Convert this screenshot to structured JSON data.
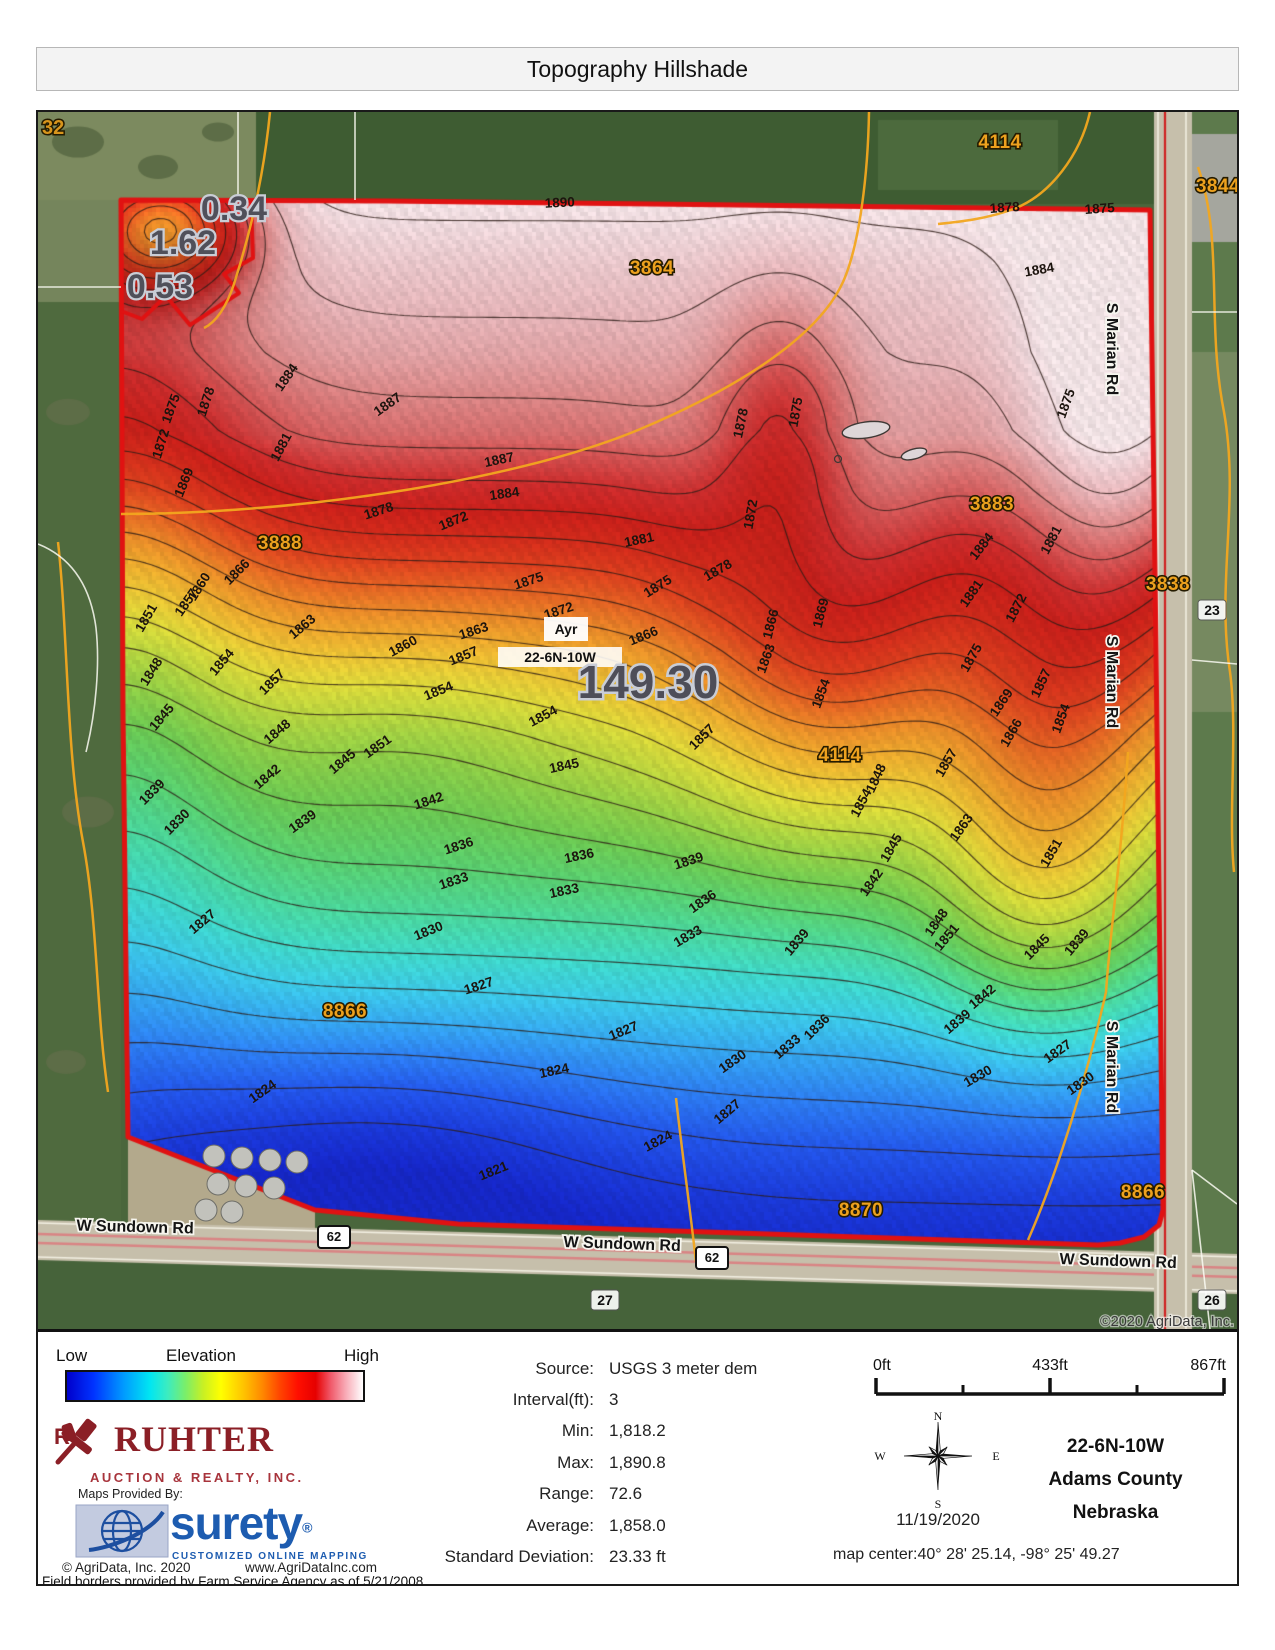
{
  "title": "Topography Hillshade",
  "legend": {
    "low": "Low",
    "label": "Elevation",
    "high": "High"
  },
  "branding": {
    "company": "RUHTER",
    "company_sub": "AUCTION & REALTY, INC.",
    "maps_provided_by": "Maps Provided By:",
    "surety": "surety",
    "surety_reg": "®",
    "surety_sub": "CUSTOMIZED ONLINE MAPPING",
    "copyright": "© AgriData, Inc. 2020",
    "website": "www.AgriDataInc.com",
    "field_borders_note": "Field borders provided by Farm Service Agency as of 5/21/2008."
  },
  "stats": {
    "rows": [
      {
        "label": "Source:",
        "value": "USGS 3 meter dem"
      },
      {
        "label": "Interval(ft):",
        "value": "3"
      },
      {
        "label": "Min:",
        "value": "1,818.2"
      },
      {
        "label": "Max:",
        "value": "1,890.8"
      },
      {
        "label": "Range:",
        "value": "72.6"
      },
      {
        "label": "Average:",
        "value": "1,858.0"
      },
      {
        "label": "Standard Deviation:",
        "value": "23.33 ft"
      }
    ]
  },
  "scalebar": {
    "ticks": [
      "0ft",
      "433ft",
      "867ft"
    ]
  },
  "location": {
    "date": "11/19/2020",
    "trs": "22-6N-10W",
    "county": "Adams County",
    "state": "Nebraska",
    "map_center": "map center:40° 28' 25.14,  -98° 25' 49.27",
    "compass": {
      "n": "N",
      "e": "E",
      "s": "S",
      "w": "W"
    }
  },
  "map": {
    "copyright": "©2020 AgriData, Inc.",
    "town_label": "Ayr",
    "trs_label": "22-6N-10W",
    "elevation": {
      "min": 1818.2,
      "max": 1890.8,
      "interval": 3
    },
    "acreage_labels": [
      {
        "t": "149.30",
        "x": 610,
        "y": 586,
        "big": true
      },
      {
        "t": "0.34",
        "x": 196,
        "y": 108,
        "big": false
      },
      {
        "t": "1.62",
        "x": 145,
        "y": 142,
        "big": false
      },
      {
        "t": "0.53",
        "x": 122,
        "y": 186,
        "big": false
      }
    ],
    "parcel_labels": [
      {
        "t": "3864",
        "x": 614,
        "y": 162
      },
      {
        "t": "4114",
        "x": 962,
        "y": 36
      },
      {
        "t": "3844",
        "x": 1180,
        "y": 80
      },
      {
        "t": "3883",
        "x": 954,
        "y": 398
      },
      {
        "t": "3888",
        "x": 242,
        "y": 437
      },
      {
        "t": "3838",
        "x": 1130,
        "y": 478
      },
      {
        "t": "4114",
        "x": 802,
        "y": 649
      },
      {
        "t": "8866",
        "x": 307,
        "y": 905
      },
      {
        "t": "8870",
        "x": 823,
        "y": 1104
      },
      {
        "t": "8866",
        "x": 1105,
        "y": 1086
      }
    ],
    "corner_section_label": "32",
    "section_labels": [
      {
        "t": "27",
        "x": 567,
        "y": 1190
      },
      {
        "t": "26",
        "x": 1174,
        "y": 1190
      },
      {
        "t": "23",
        "x": 1174,
        "y": 500
      }
    ],
    "route_shields": [
      {
        "t": "62",
        "x": 296,
        "y": 1125
      },
      {
        "t": "62",
        "x": 674,
        "y": 1146
      }
    ],
    "road_labels": [
      {
        "t": "S Marian Rd",
        "x": 1069,
        "y": 237,
        "r": 90
      },
      {
        "t": "S Marian Rd",
        "x": 1069,
        "y": 570,
        "r": 90
      },
      {
        "t": "S Marian Rd",
        "x": 1069,
        "y": 955,
        "r": 90
      },
      {
        "t": "W Sundown Rd",
        "x": 97,
        "y": 1120,
        "r": 1.5
      },
      {
        "t": "W Sundown Rd",
        "x": 584,
        "y": 1137,
        "r": 2
      },
      {
        "t": "W Sundown Rd",
        "x": 1080,
        "y": 1154,
        "r": 2
      }
    ],
    "contour_labels": [
      [
        "1890",
        522,
        95,
        -3
      ],
      [
        "1887",
        462,
        352,
        -12
      ],
      [
        "1887",
        352,
        296,
        -35
      ],
      [
        "1884",
        252,
        268,
        -55
      ],
      [
        "1884",
        467,
        386,
        -8
      ],
      [
        "1884",
        1002,
        162,
        -10
      ],
      [
        "1884",
        947,
        437,
        -52
      ],
      [
        "1881",
        247,
        337,
        -62
      ],
      [
        "1881",
        602,
        432,
        -12
      ],
      [
        "1881",
        937,
        484,
        -55
      ],
      [
        "1881",
        1017,
        430,
        -62
      ],
      [
        "1878",
        172,
        291,
        -72
      ],
      [
        "1878",
        342,
        403,
        -18
      ],
      [
        "1878",
        682,
        462,
        -30
      ],
      [
        "1878",
        707,
        312,
        -78
      ],
      [
        "1878",
        967,
        100,
        -4
      ],
      [
        "1875",
        137,
        298,
        -70
      ],
      [
        "1875",
        492,
        473,
        -18
      ],
      [
        "1875",
        622,
        478,
        -32
      ],
      [
        "1875",
        762,
        301,
        -80
      ],
      [
        "1875",
        1062,
        101,
        -4
      ],
      [
        "1875",
        937,
        548,
        -60
      ],
      [
        "1875",
        1032,
        293,
        -70
      ],
      [
        "1872",
        127,
        333,
        -73
      ],
      [
        "1872",
        417,
        413,
        -22
      ],
      [
        "1872",
        522,
        503,
        -18
      ],
      [
        "1872",
        717,
        403,
        -80
      ],
      [
        "1872",
        982,
        498,
        -62
      ],
      [
        "1869",
        150,
        372,
        -68
      ],
      [
        "1869",
        787,
        502,
        -76
      ],
      [
        "1869",
        967,
        593,
        -56
      ],
      [
        "1866",
        202,
        463,
        -45
      ],
      [
        "1866",
        607,
        528,
        -22
      ],
      [
        "1866",
        737,
        513,
        -76
      ],
      [
        "1866",
        977,
        623,
        -60
      ],
      [
        "1863",
        267,
        518,
        -40
      ],
      [
        "1863",
        437,
        523,
        -18
      ],
      [
        "1863",
        732,
        548,
        -70
      ],
      [
        "1863",
        927,
        718,
        -55
      ],
      [
        "1860",
        165,
        477,
        -58
      ],
      [
        "1860",
        367,
        538,
        -28
      ],
      [
        "1857",
        152,
        493,
        -55
      ],
      [
        "1857",
        237,
        573,
        -45
      ],
      [
        "1857",
        427,
        548,
        -22
      ],
      [
        "1857",
        667,
        628,
        -45
      ],
      [
        "1857",
        912,
        653,
        -60
      ],
      [
        "1857",
        1007,
        573,
        -65
      ],
      [
        "1854",
        187,
        553,
        -50
      ],
      [
        "1854",
        402,
        583,
        -22
      ],
      [
        "1854",
        507,
        608,
        -28
      ],
      [
        "1854",
        787,
        583,
        -70
      ],
      [
        "1854",
        827,
        693,
        -62
      ],
      [
        "1854",
        1027,
        608,
        -70
      ],
      [
        "1851",
        112,
        508,
        -60
      ],
      [
        "1851",
        342,
        638,
        -35
      ],
      [
        "1851",
        912,
        828,
        -50
      ],
      [
        "1851",
        1017,
        743,
        -60
      ],
      [
        "1848",
        117,
        562,
        -58
      ],
      [
        "1848",
        242,
        623,
        -40
      ],
      [
        "1848",
        842,
        668,
        -65
      ],
      [
        "1848",
        902,
        813,
        -55
      ],
      [
        "1845",
        127,
        608,
        -50
      ],
      [
        "1845",
        307,
        653,
        -40
      ],
      [
        "1845",
        527,
        658,
        -12
      ],
      [
        "1845",
        857,
        738,
        -60
      ],
      [
        "1845",
        1002,
        838,
        -45
      ],
      [
        "1842",
        232,
        668,
        -40
      ],
      [
        "1842",
        392,
        693,
        -18
      ],
      [
        "1842",
        837,
        773,
        -55
      ],
      [
        "1842",
        947,
        888,
        -40
      ],
      [
        "1839",
        117,
        683,
        -45
      ],
      [
        "1839",
        267,
        713,
        -35
      ],
      [
        "1839",
        652,
        753,
        -18
      ],
      [
        "1839",
        762,
        833,
        -50
      ],
      [
        "1839",
        1042,
        833,
        -50
      ],
      [
        "1839",
        922,
        913,
        -40
      ],
      [
        "1836",
        422,
        738,
        -18
      ],
      [
        "1836",
        542,
        748,
        -12
      ],
      [
        "1836",
        667,
        793,
        -35
      ],
      [
        "1836",
        782,
        918,
        -45
      ],
      [
        "1833",
        417,
        773,
        -18
      ],
      [
        "1833",
        527,
        783,
        -12
      ],
      [
        "1833",
        652,
        828,
        -30
      ],
      [
        "1833",
        752,
        938,
        -40
      ],
      [
        "1830",
        142,
        713,
        -45
      ],
      [
        "1830",
        392,
        823,
        -22
      ],
      [
        "1830",
        697,
        953,
        -35
      ],
      [
        "1830",
        942,
        968,
        -30
      ],
      [
        "1830",
        1045,
        975,
        -35
      ],
      [
        "1827",
        167,
        813,
        -40
      ],
      [
        "1827",
        442,
        878,
        -18
      ],
      [
        "1827",
        587,
        923,
        -22
      ],
      [
        "1827",
        692,
        1003,
        -40
      ],
      [
        "1827",
        1022,
        943,
        -35
      ],
      [
        "1824",
        227,
        983,
        -35
      ],
      [
        "1824",
        517,
        963,
        -12
      ],
      [
        "1824",
        622,
        1033,
        -28
      ],
      [
        "1821",
        457,
        1063,
        -22
      ]
    ]
  }
}
